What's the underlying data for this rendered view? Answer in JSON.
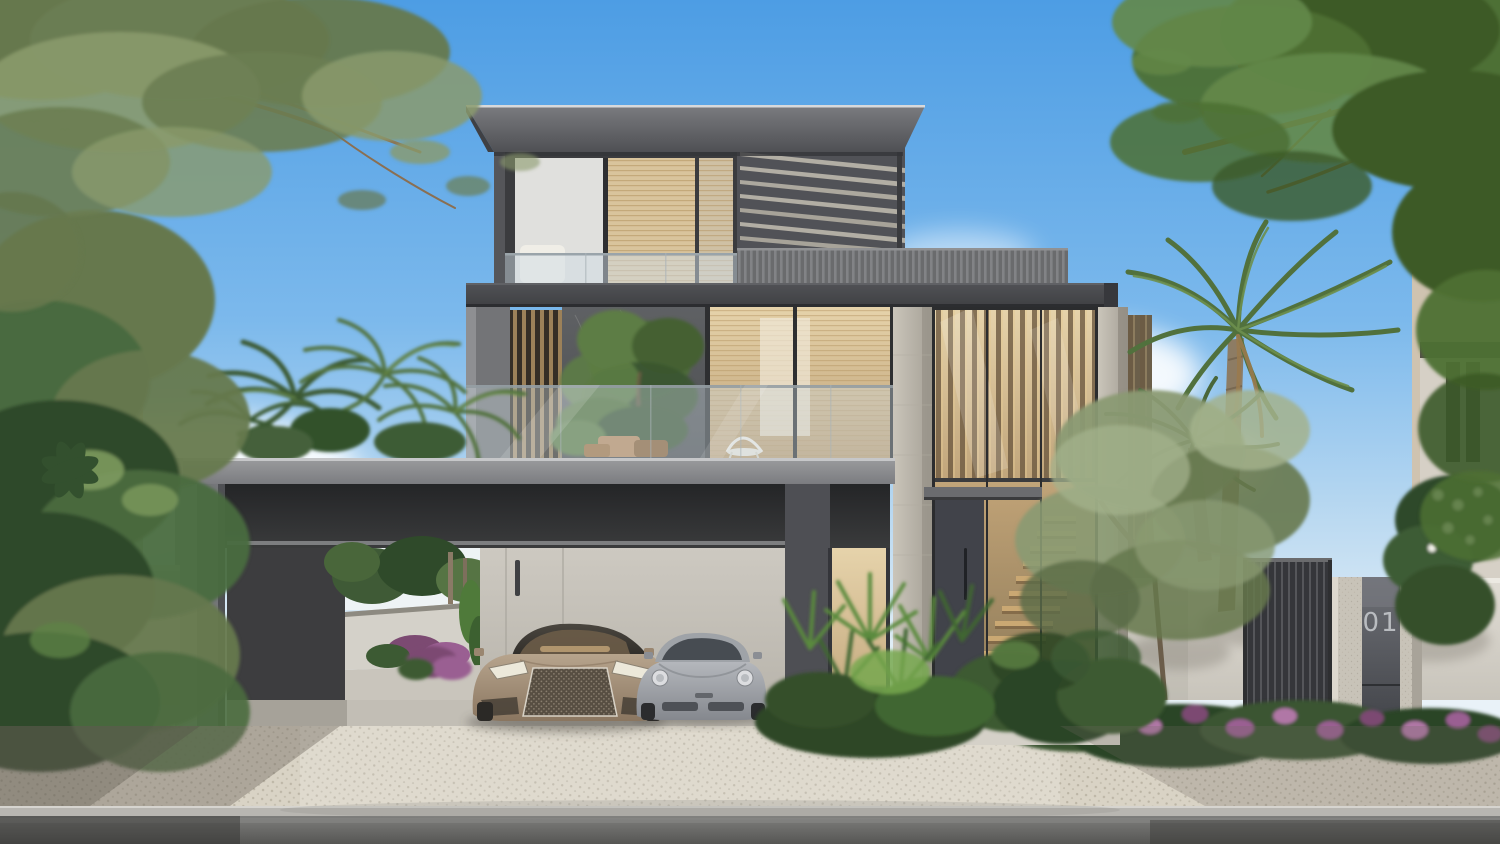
{
  "scene": {
    "type": "architectural-exterior-render",
    "setting": "modern three-storey luxury villa with double-height glass entrance, carport with two sports cars, tropical landscaping, sunny day",
    "address_number": "01",
    "floors": 3,
    "cars": [
      {
        "position": "left",
        "style": "luxury coupe",
        "color_name": "champagne"
      },
      {
        "position": "right",
        "style": "sports coupe",
        "color_name": "silver"
      }
    ],
    "landscape": [
      "overhanging olive branches",
      "date palms",
      "olive tree",
      "fan palms",
      "purple flower beds",
      "white frangipani",
      "white compound wall",
      "dark louvered gate"
    ],
    "ground": [
      "cobblestone driveway",
      "concrete curb",
      "asphalt road"
    ]
  },
  "palette": {
    "skyTop": "#4d9de4",
    "skyMid": "#7cb9ec",
    "skyLow": "#bcdaf1",
    "horizon": "#e9f2f8",
    "cloud": "#ffffff",
    "roofTop": "#7a7b7f",
    "roofBot": "#4f5054",
    "fasciaTop": "#515256",
    "fasciaBot": "#3f4043",
    "slabTop": "#9b9c9e",
    "slabBot": "#7b7c80",
    "concreteLit": "#a6a7a9",
    "concreteMid": "#75767a",
    "concreteDark": "#4e4f54",
    "ribLight": "#828386",
    "ribDark": "#6a6b6d",
    "glassCool": "#cfdce5",
    "warmHigh": "#e6d3ab",
    "warmLow": "#bc9f74",
    "bronze": "#6d5940",
    "bronzeHi": "#e3c892",
    "blind": "#b3925f",
    "marbleHi": "#5f6164",
    "marbleLo": "#4b4d50",
    "stoneHi": "#cac5ba",
    "stoneLo": "#a5a096",
    "wallIntHi": "#cdc9c1",
    "wallIntLo": "#b4b0a7",
    "beamDark": "#242527",
    "beamDark2": "#3a3b3c",
    "compoundHi": "#e0dcd4",
    "compoundLo": "#c8c4bb",
    "wallLight": "#d8d4cb",
    "green1": "#4e7034",
    "green2": "#3c5a28",
    "green3": "#648849",
    "olive1": "#8a9a72",
    "olive2": "#66784e",
    "oliveDark": "#2e4829",
    "palm1": "#51713d",
    "palm2": "#3a5830",
    "palmLight": "#6d8f4e",
    "trunk": "#8d7c64",
    "branch": "#7d6248",
    "purple": "#9a5f92",
    "purpleHi": "#b077a6",
    "purpleLo": "#7c4a72",
    "cobbleBase": "#d9d3c5",
    "cobbleDot": "#b3ac9c",
    "curb": "#b8b6b1",
    "roadHi": "#7e7e7c",
    "roadLo": "#565654",
    "champHi": "#b7a48d",
    "champLo": "#8a7660",
    "silverHi": "#b4b7bc",
    "silverLo": "#85888e",
    "cabHi": "#4a463f",
    "cabLo": "#2f2c28",
    "gateDark": "#35363a",
    "metalHi": "#6e7076",
    "metalLo": "#3e4045",
    "number": "#b9bcc0",
    "stepWood": "#caa873",
    "stepShadow": "#7a6040",
    "doorDark": "#41434a",
    "shadow": "#6f6a60",
    "pathLight": "#d5d1c8"
  }
}
